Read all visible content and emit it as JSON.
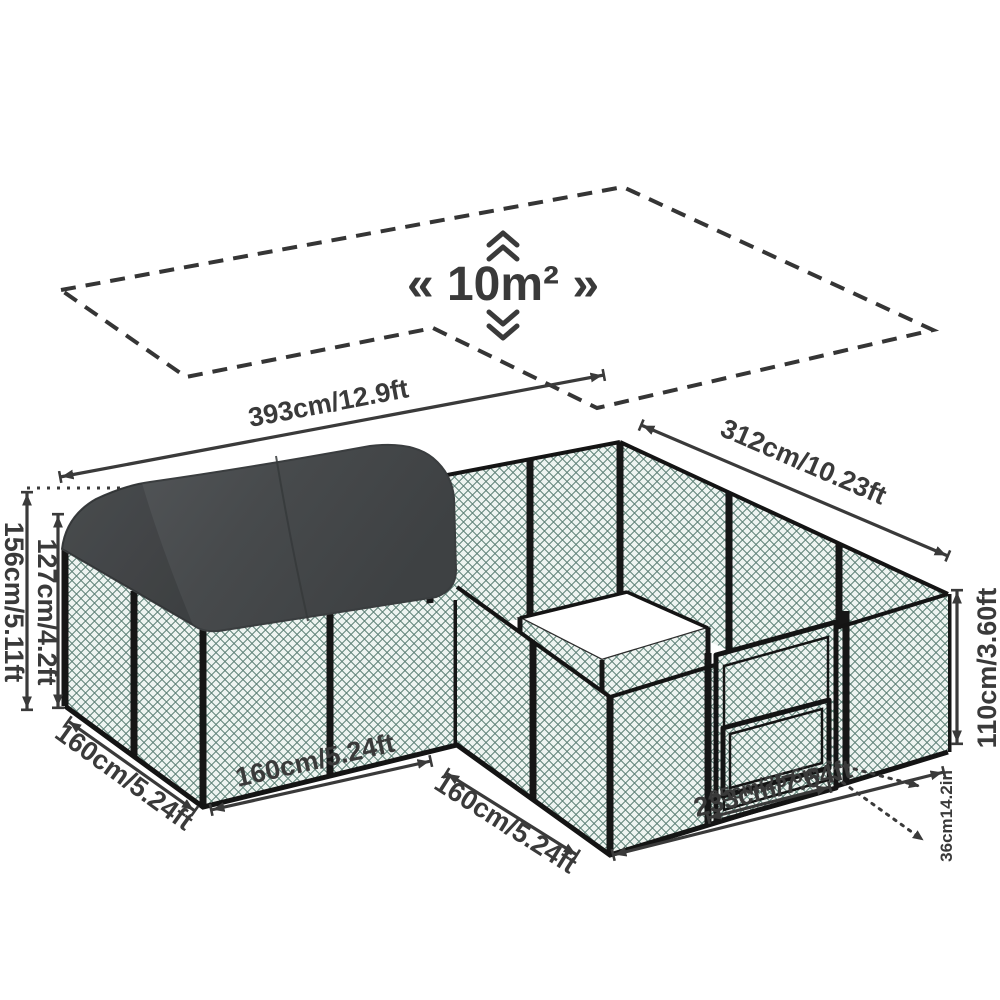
{
  "diagram": {
    "title_area_label": "« 10m² »",
    "dimensions": {
      "total_width": "393cm/12.9ft",
      "right_depth": "312cm/10.23ft",
      "peak_height": "156cm/5.11ft",
      "covered_wall_height": "127cm/4.2ft",
      "left_side_depth": "160cm/5.24ft",
      "left_front_width": "160cm/5.24ft",
      "notch_side_depth": "160cm/5.24ft",
      "fence_height": "110cm/3.60ft",
      "gate_width": "65cm/25.6in",
      "front_right_width": "233cm/7.64ft",
      "dog_door_height": "36cm14.2in"
    },
    "colors": {
      "mesh_green": "#2e5c50",
      "mesh_bg": "#eef4f1",
      "frame_black": "#161616",
      "roof_gray": "#47494b",
      "dimension_text": "#3a3a3a",
      "background": "#ffffff"
    }
  }
}
